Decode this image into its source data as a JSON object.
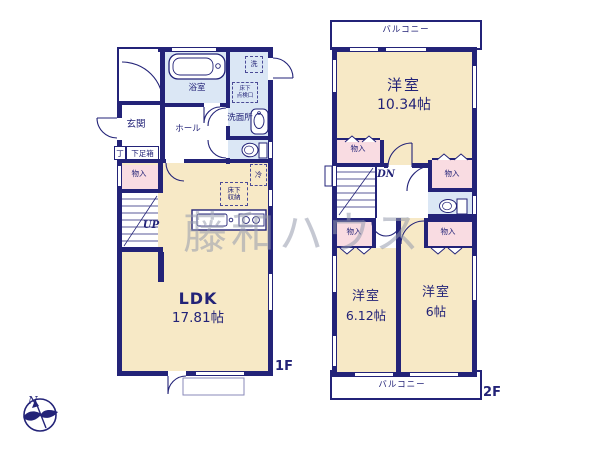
{
  "palette": {
    "wall_navy": "#232378",
    "room_beige": "#f7e9c6",
    "closet_pink": "#f9dce2",
    "wet_area_blue": "#dbe7f5",
    "watermark_gray": "#969cae"
  },
  "watermark": "藤和ハウス",
  "compass": {
    "north_label": "N"
  },
  "floor1": {
    "floor_label": "1F",
    "entrance": "玄関",
    "hall": "ホール",
    "bathroom": "浴室",
    "washer_symbol": "洗",
    "underfloor_hatch_line1": "床下",
    "underfloor_hatch_line2": "点検口",
    "washroom": "洗面所",
    "shoe_counter": "丁",
    "shoe_box": "下足箱",
    "storage": "物入",
    "stairs_up": "UP",
    "underfloor_storage_line1": "床下",
    "underfloor_storage_line2": "収納",
    "fridge_symbol": "冷",
    "ldk_label": "LDK",
    "ldk_size": "17.81帖"
  },
  "floor2": {
    "floor_label": "2F",
    "balcony_top": "バルコニー",
    "balcony_bottom": "バルコニー",
    "bedroom_large_label": "洋室",
    "bedroom_large_size": "10.34帖",
    "bedroom_mid_label": "洋室",
    "bedroom_mid_size": "6.12帖",
    "bedroom_small_label": "洋室",
    "bedroom_small_size": "6帖",
    "storage": "物入",
    "stairs_down": "DN"
  }
}
